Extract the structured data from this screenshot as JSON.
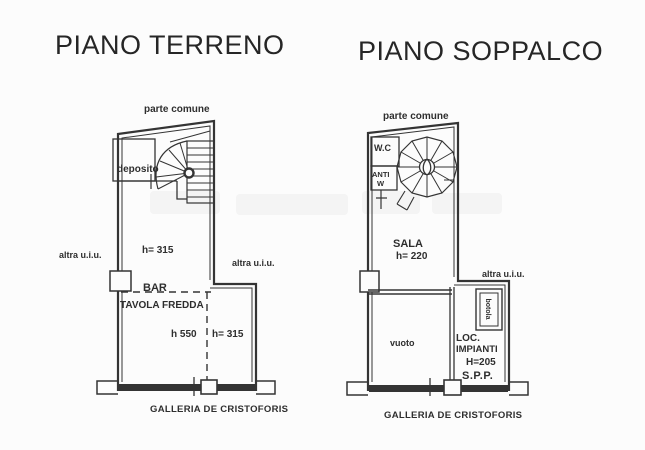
{
  "page": {
    "paper_color": "#fcfcfc",
    "ink_color": "#303030"
  },
  "plans": {
    "left": {
      "title": "PIANO TERRENO",
      "labels": {
        "parte_comune": "parte comune",
        "deposito": "deposito",
        "h_upper": "h= 315",
        "bar": "BAR",
        "tavola_fredda": "TAVOLA FREDDA",
        "h_550": "h 550",
        "h_lower": "h= 315",
        "altra_uiu_left": "altra u.i.u.",
        "altra_uiu_right": "altra u.i.u.",
        "street": "GALLERIA DE CRISTOFORIS"
      }
    },
    "right": {
      "title": "PIANO SOPPALCO",
      "labels": {
        "parte_comune": "parte comune",
        "wc": "W.C",
        "anti": "ANTI",
        "anti_w": "W",
        "sala": "SALA",
        "h_sala": "h= 220",
        "altra_uiu": "altra u.i.u.",
        "vuoto": "vuoto",
        "botola": "botola",
        "loc": "LOC.",
        "impianti": "IMPIANTI",
        "h_loc": "H=205",
        "spp": "S.P.P.",
        "street": "GALLERIA DE CRISTOFORIS"
      }
    }
  }
}
